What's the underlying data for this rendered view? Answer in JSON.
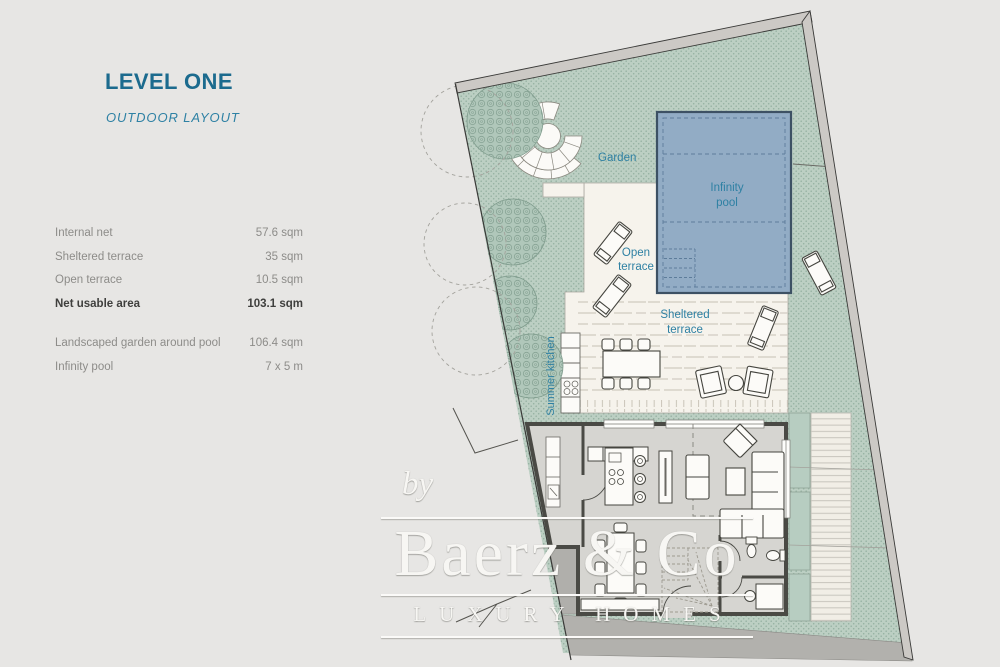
{
  "header": {
    "title": "LEVEL ONE",
    "subtitle": "OUTDOOR LAYOUT"
  },
  "area_table": {
    "rows": [
      {
        "label": "Internal net",
        "value": "57.6 sqm"
      },
      {
        "label": "Sheltered terrace",
        "value": "35 sqm"
      },
      {
        "label": "Open terrace",
        "value": "10.5 sqm"
      },
      {
        "label": "Net usable area",
        "value": "103.1 sqm"
      },
      {
        "label": "Landscaped garden around pool",
        "value": "106.4 sqm"
      },
      {
        "label": "Infinity pool",
        "value": "7 x 5 m"
      }
    ]
  },
  "plan": {
    "labels": {
      "garden": "Garden",
      "infinity_1": "Infinity",
      "infinity_2": "pool",
      "open_1": "Open",
      "open_2": "terrace",
      "sheltered_1": "Sheltered",
      "sheltered_2": "terrace",
      "summer_kitchen": "Summer kitchen"
    },
    "colors": {
      "background": "#e7e6e4",
      "garden_green": "#bccfc3",
      "pool_blue": "#92acc5",
      "terrace_cream": "#f6f3ec",
      "floor_gray": "#d6d5d1",
      "wall_dark": "#4a4a45",
      "label_teal": "#2e80a3",
      "title_teal": "#1c6b8e",
      "muted_text": "#8d8c89",
      "dark_text": "#3f3f3d"
    }
  },
  "watermark": {
    "prefix": "by",
    "brand": "Baerz & Co",
    "tagline": "LUXURY HOMES"
  }
}
